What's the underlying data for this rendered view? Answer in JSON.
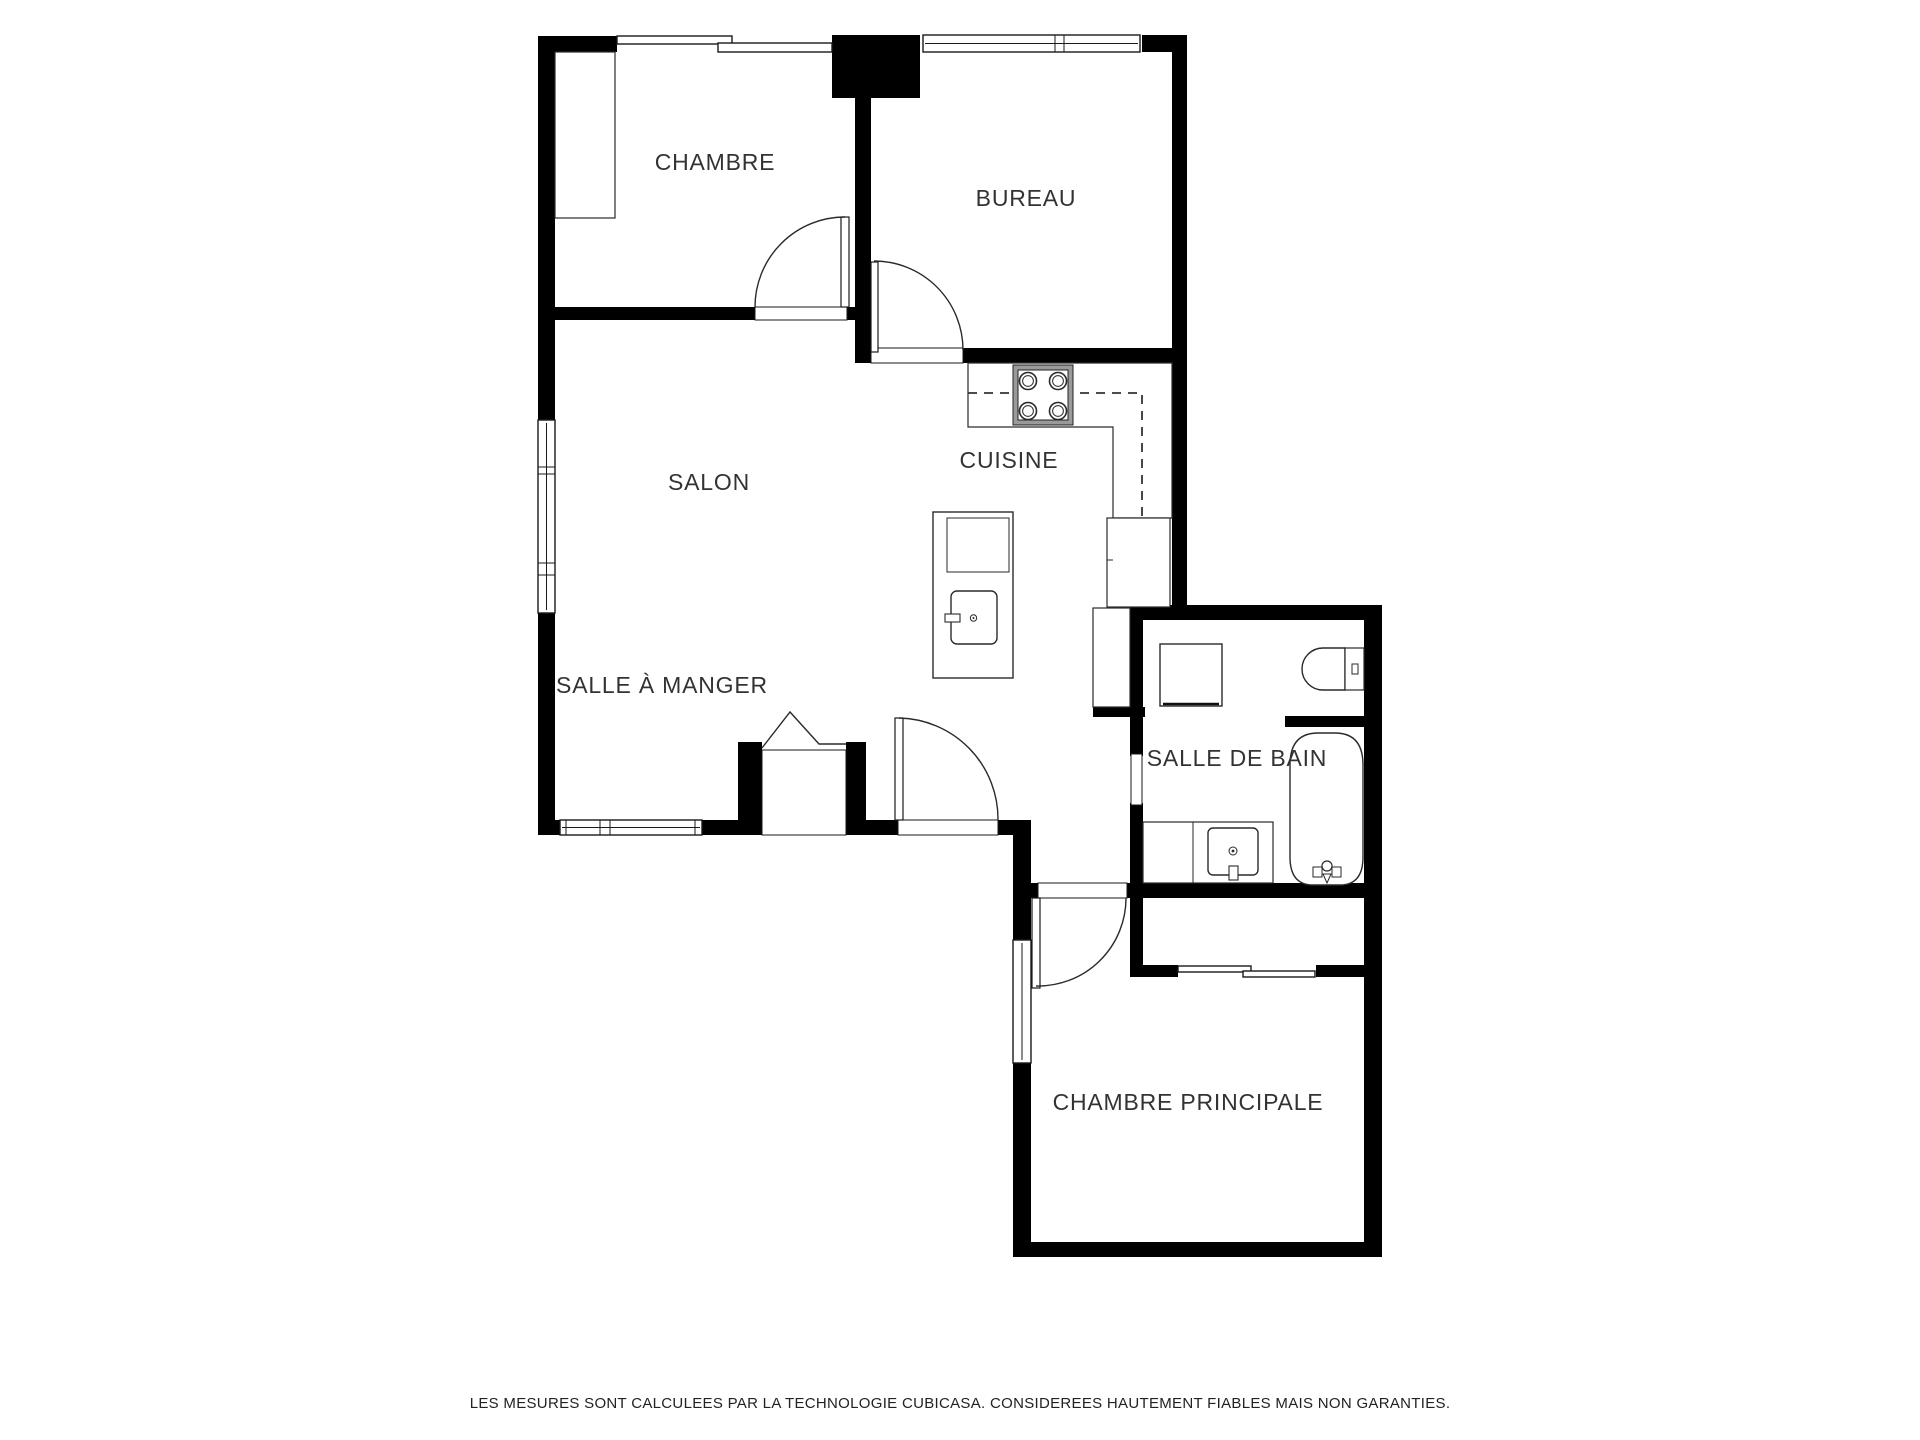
{
  "canvas": {
    "width": 1920,
    "height": 1440,
    "background": "#ffffff"
  },
  "rooms": {
    "chambre": {
      "label": "CHAMBRE"
    },
    "bureau": {
      "label": "BUREAU"
    },
    "salon": {
      "label": "SALON"
    },
    "cuisine": {
      "label": "CUISINE"
    },
    "salle_a_manger": {
      "label": "SALLE À MANGER"
    },
    "salle_de_bain": {
      "label": "SALLE DE BAIN"
    },
    "chambre_principale": {
      "label": "CHAMBRE PRINCIPALE"
    }
  },
  "fixtures": [
    "stove-icon",
    "kitchen-island",
    "island-sink-icon",
    "dishwasher-icon",
    "refrigerator-icon",
    "washing-machine-icon",
    "toilet-icon",
    "bathtub-icon",
    "bathtub-faucet-icon",
    "vanity-sink-icon",
    "closet",
    "sliding-closet-door",
    "pocket-door",
    "swing-door",
    "double-entry-door",
    "window"
  ],
  "colors": {
    "wall": "#000000",
    "line": "#2a2a2a",
    "label": "#333333"
  },
  "footer": {
    "disclaimer": "LES MESURES SONT CALCULEES PAR LA TECHNOLOGIE CUBICASA. CONSIDEREES HAUTEMENT FIABLES MAIS NON GARANTIES."
  }
}
